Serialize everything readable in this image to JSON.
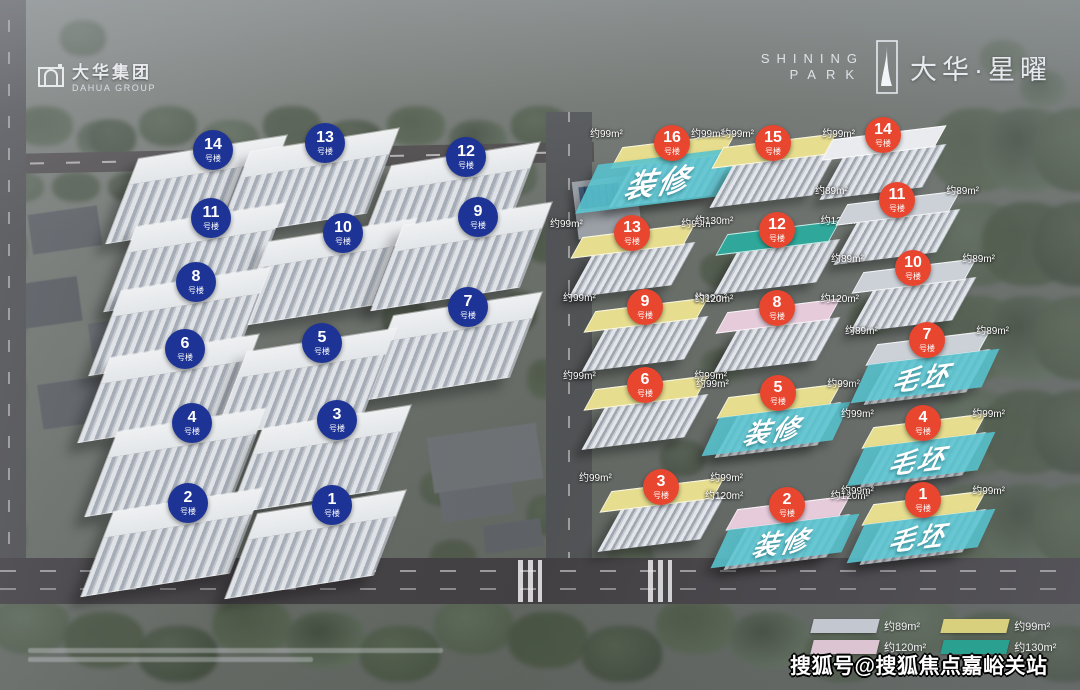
{
  "branding": {
    "dahua_logo": {
      "cn": "大华集团",
      "en": "DAHUA GROUP"
    },
    "project_logo": {
      "en_line1": "SHINING",
      "en_line2": "PARK",
      "cn": "大华·星曜"
    }
  },
  "watermark": "搜狐号@搜狐焦点嘉峪关站",
  "legend": [
    {
      "label": "约89m²",
      "color": "#c3c8d0"
    },
    {
      "label": "约99m²",
      "color": "#d9d07e"
    },
    {
      "label": "约120m²",
      "color": "#dcc4d2"
    },
    {
      "label": "约130m²",
      "color": "#2aa091"
    }
  ],
  "colors": {
    "blue_marker": "#1d3496",
    "red_marker": "#e8462f",
    "status_banner": "#56c3ce",
    "roof_89": "#ccd1d8",
    "roof_99": "#e6dd8e",
    "roof_120": "#e6cbdb",
    "roof_130": "#2fa89b",
    "roof_none": "#e9ebee"
  },
  "plan": {
    "label_suffix": "号楼",
    "blue_buildings": [
      {
        "num": "14",
        "x": 213,
        "y": 150
      },
      {
        "num": "13",
        "x": 325,
        "y": 143
      },
      {
        "num": "12",
        "x": 466,
        "y": 157
      },
      {
        "num": "11",
        "x": 211,
        "y": 218
      },
      {
        "num": "10",
        "x": 343,
        "y": 233
      },
      {
        "num": "9",
        "x": 478,
        "y": 217
      },
      {
        "num": "8",
        "x": 196,
        "y": 282
      },
      {
        "num": "7",
        "x": 468,
        "y": 307
      },
      {
        "num": "6",
        "x": 185,
        "y": 349
      },
      {
        "num": "5",
        "x": 322,
        "y": 343
      },
      {
        "num": "4",
        "x": 192,
        "y": 423
      },
      {
        "num": "3",
        "x": 337,
        "y": 420
      },
      {
        "num": "2",
        "x": 188,
        "y": 503
      },
      {
        "num": "1",
        "x": 332,
        "y": 505
      }
    ],
    "red_buildings": [
      {
        "num": "16",
        "x": 672,
        "y": 143,
        "roof": "99",
        "area": "约99m²",
        "banner": "装修",
        "banner_big": true
      },
      {
        "num": "15",
        "x": 773,
        "y": 143,
        "roof": "99",
        "area": "约99m²",
        "banner": null
      },
      {
        "num": "14",
        "x": 883,
        "y": 135,
        "roof": null,
        "area": null,
        "banner": null
      },
      {
        "num": "13",
        "x": 632,
        "y": 233,
        "roof": "99",
        "area": "约99m²",
        "banner": null
      },
      {
        "num": "12",
        "x": 777,
        "y": 230,
        "roof": "130",
        "area": "约130m²",
        "banner": null
      },
      {
        "num": "11",
        "x": 897,
        "y": 200,
        "roof": "89",
        "area": "约89m²",
        "banner": null
      },
      {
        "num": "9",
        "x": 645,
        "y": 307,
        "roof": "99",
        "area": "约99m²",
        "banner": null
      },
      {
        "num": "8",
        "x": 777,
        "y": 308,
        "roof": "120",
        "area": "约120m²",
        "banner": null
      },
      {
        "num": "10",
        "x": 913,
        "y": 268,
        "roof": "89",
        "area": "约89m²",
        "banner": null
      },
      {
        "num": "6",
        "x": 645,
        "y": 385,
        "roof": "99",
        "area": "约99m²",
        "banner": null
      },
      {
        "num": "5",
        "x": 778,
        "y": 393,
        "roof": "99",
        "area": "约99m²",
        "banner": "装修"
      },
      {
        "num": "7",
        "x": 927,
        "y": 340,
        "roof": "89",
        "area": "约89m²",
        "banner": "毛坯"
      },
      {
        "num": "4",
        "x": 923,
        "y": 423,
        "roof": "99",
        "area": "约99m²",
        "banner": "毛坯"
      },
      {
        "num": "3",
        "x": 661,
        "y": 487,
        "roof": "99",
        "area": "约99m²",
        "banner": null
      },
      {
        "num": "2",
        "x": 787,
        "y": 505,
        "roof": "120",
        "area": "约120m²",
        "banner": "装修"
      },
      {
        "num": "1",
        "x": 923,
        "y": 500,
        "roof": "99",
        "area": "约99m²",
        "banner": "毛坯"
      }
    ]
  }
}
